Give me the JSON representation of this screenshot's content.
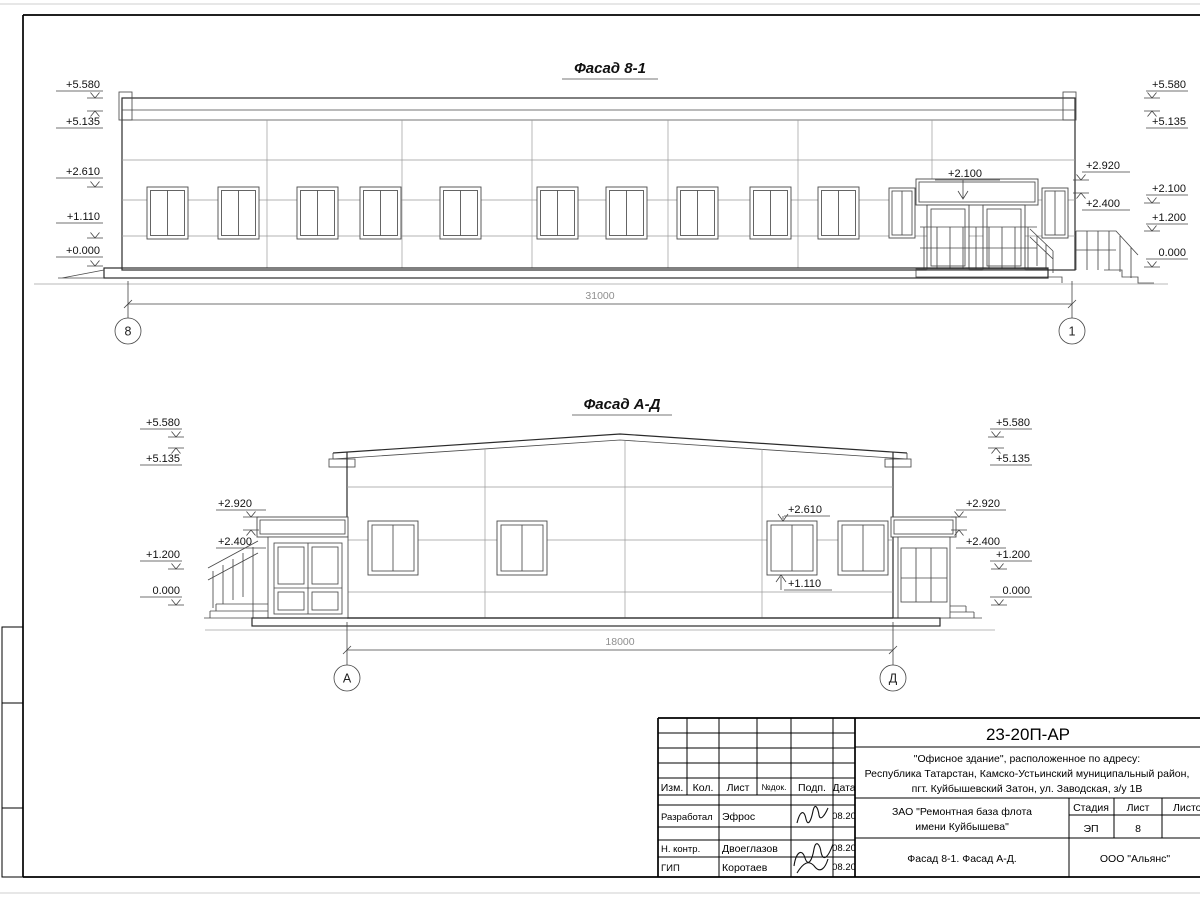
{
  "sheet": {
    "background": "#ffffff",
    "line_color": "#2b2b2b",
    "panel_line_color": "#9a9a9a",
    "dim_text_color": "#8f8f8f"
  },
  "facade1": {
    "title": "Фасад 8-1",
    "marks_left": [
      "+5.580",
      "+5.135",
      "+2.610",
      "+1.110",
      "+0.000"
    ],
    "marks_right_inner": [
      "+2.920",
      "+2.400"
    ],
    "marks_right_outer": [
      "+5.580",
      "+5.135",
      "+2.100",
      "+1.200",
      "0.000"
    ],
    "entrance_mark": "+2.100",
    "dimension": "31000",
    "axis_left": "8",
    "axis_right": "1"
  },
  "facade2": {
    "title": "Фасад А-Д",
    "marks_left_outer": [
      "+5.580",
      "+5.135",
      "+1.200",
      "0.000"
    ],
    "marks_left_inner": [
      "+2.920",
      "+2.400"
    ],
    "marks_right_inner": [
      "+2.920",
      "+2.400"
    ],
    "marks_right_outer": [
      "+5.580",
      "+5.135",
      "+1.200",
      "0.000"
    ],
    "window_mark_top": "+2.610",
    "window_mark_bottom": "+1.110",
    "dimension": "18000",
    "axis_left": "А",
    "axis_right": "Д"
  },
  "titleblock": {
    "doc_code": "23-20П-АР",
    "object_line1": "\"Офисное здание\", расположенное по адресу:",
    "object_line2": "Республика Татарстан, Камско-Устьинский муниципальный район,",
    "object_line3": "пгт. Куйбышевский Затон, ул. Заводская, з/у 1В",
    "client_line1": "ЗАО \"Ремонтная база флота",
    "client_line2": "имени Куйбышева\"",
    "sheet_title": "Фасад 8-1. Фасад А-Д.",
    "organization": "ООО \"Альянс\"",
    "headers": {
      "izm": "Изм.",
      "kol": "Кол.",
      "list": "Лист",
      "ndok": "№док.",
      "podp": "Подп.",
      "data": "Дата"
    },
    "stage_col": {
      "label_stage": "Стадия",
      "label_sheet": "Лист",
      "label_sheets": "Листов",
      "stage": "ЭП",
      "sheet": "8",
      "sheets": ""
    },
    "rows": [
      {
        "role": "Разработал",
        "name": "Эфрос",
        "date": "08.20"
      },
      {
        "role": "Н. контр.",
        "name": "Двоеглазов",
        "date": "08.20"
      },
      {
        "role": "ГИП",
        "name": "Коротаев",
        "date": "08.20"
      }
    ]
  }
}
